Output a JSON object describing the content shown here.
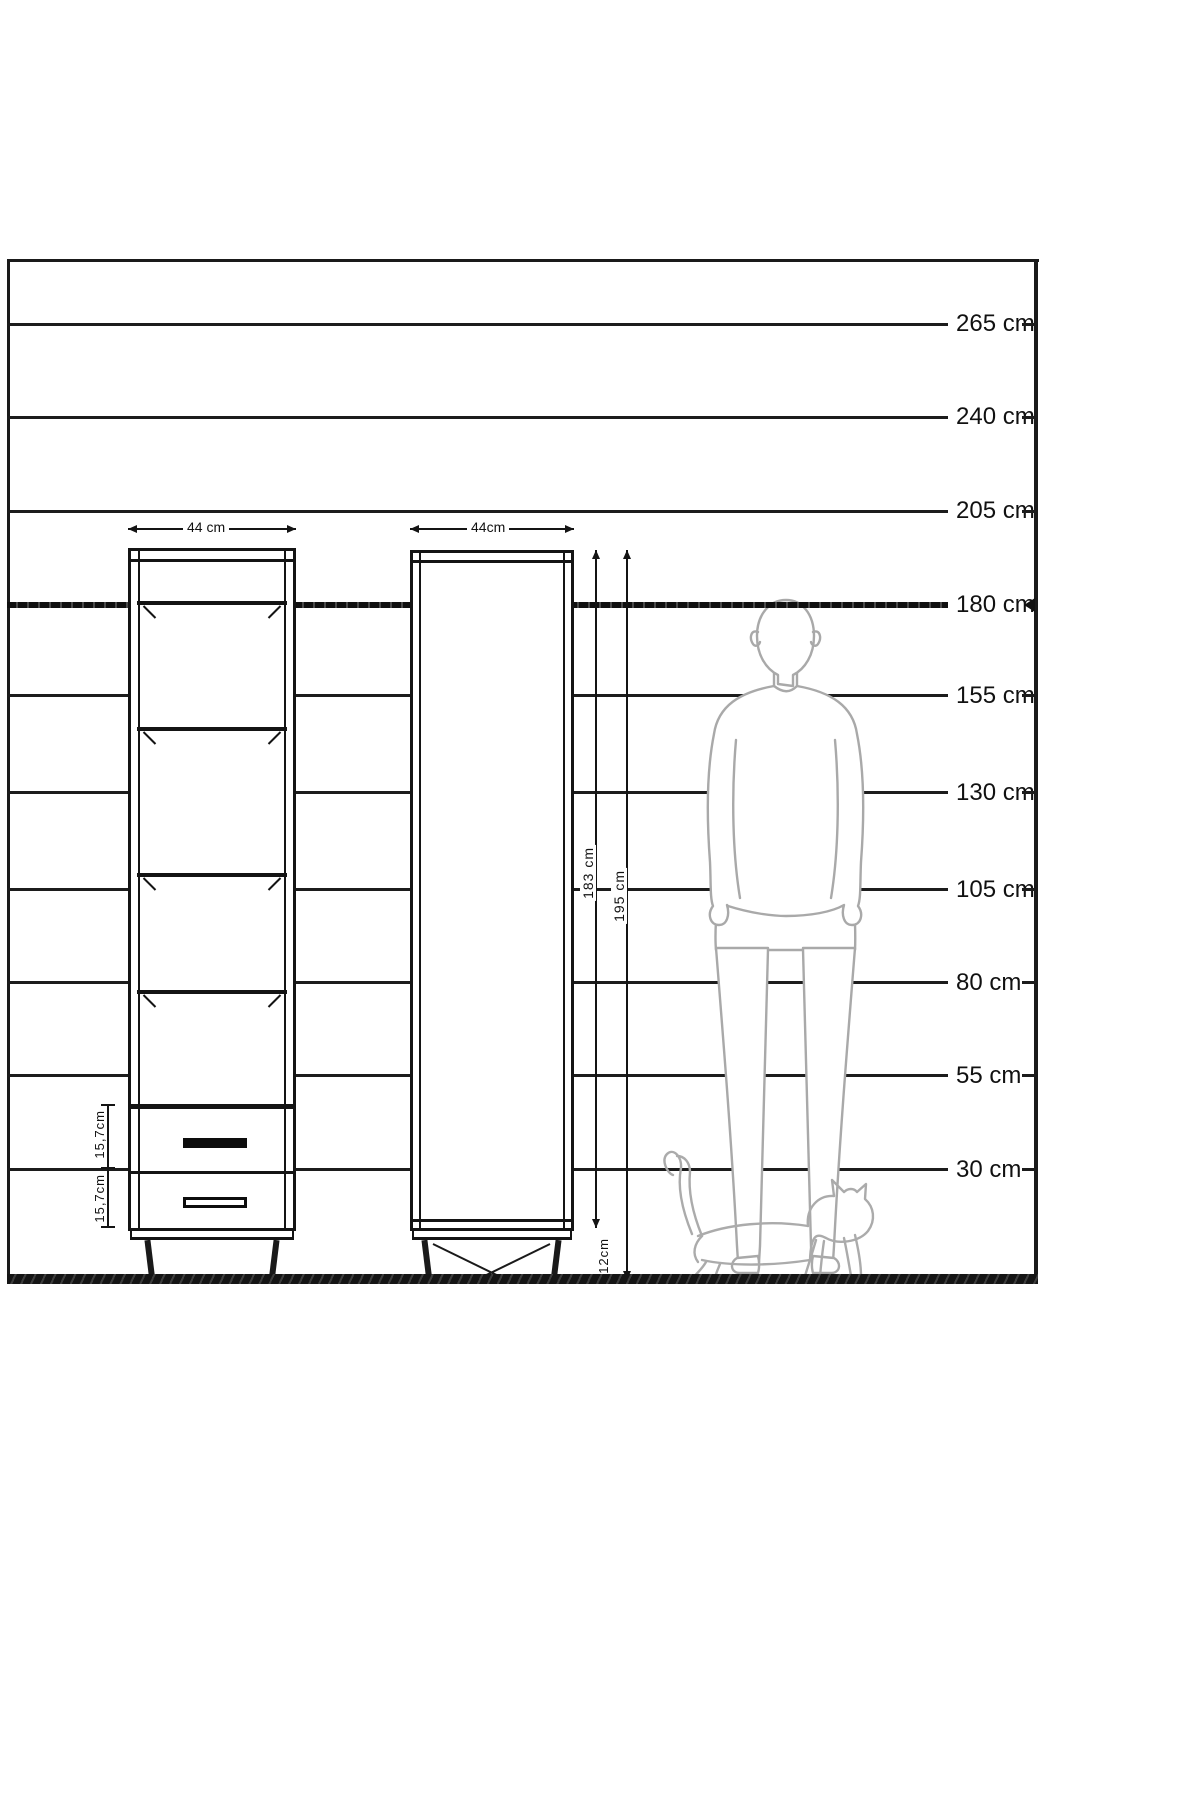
{
  "diagram_title": "cabinet-height-comparison-diagram",
  "unit": "cm",
  "height_scale": [
    {
      "label": "265 cm",
      "value": 265
    },
    {
      "label": "240 cm",
      "value": 240
    },
    {
      "label": "205 cm",
      "value": 205
    },
    {
      "label": "180 cm",
      "value": 180
    },
    {
      "label": "155 cm",
      "value": 155
    },
    {
      "label": "130 cm",
      "value": 130
    },
    {
      "label": "105 cm",
      "value": 105
    },
    {
      "label": "80 cm",
      "value": 80
    },
    {
      "label": "55 cm",
      "value": 55
    },
    {
      "label": "30 cm",
      "value": 30
    }
  ],
  "cabinet_left": {
    "type": "open-shelf-unit-with-drawers",
    "width_label": "44 cm",
    "drawer1_label": "15,7cm",
    "drawer2_label": "15,7cm"
  },
  "cabinet_right": {
    "type": "single-door-cabinet",
    "width_label": "44cm",
    "body_height_label": "183 cm",
    "total_height_label": "195 cm",
    "leg_height_label": "12cm"
  },
  "silhouettes": {
    "man": "standing man, back view, reference height at 180 cm line",
    "cat": "walking cat at floor level"
  },
  "colors": {
    "line": "#141414",
    "silhouette": "#a9a9a9",
    "background": "#ffffff"
  }
}
